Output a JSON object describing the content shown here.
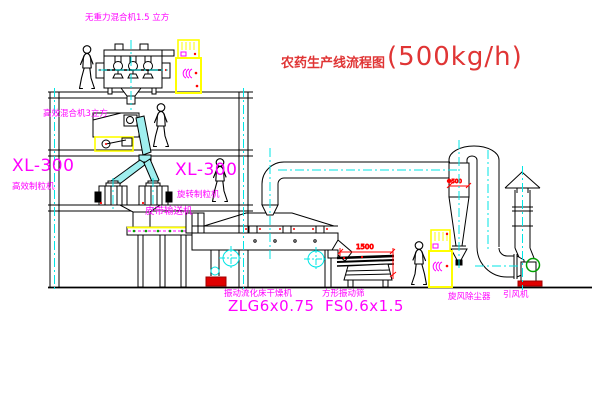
{
  "title": {
    "text": "农药生产线流程图",
    "capacity": "(500kg/h)"
  },
  "labels": {
    "gravity_free_mixer": "无重力混合机1.5 立方",
    "high_efficiency_mixer": "高效混合机3立方",
    "left_granulator_model": "XL-300",
    "left_granulator_name": "高效制粒机",
    "mid_granulator_model": "XL-300",
    "mid_granulator_name": "旋转制粒机",
    "belt_conveyor": "皮带输送机",
    "dryer_name": "振动流化床干燥机",
    "dryer_model": "ZLG6x0.75",
    "screen_name": "方形振动筛",
    "screen_model": "FS0.6x1.5",
    "cyclone": "旋风除尘器",
    "fan": "引风机"
  },
  "dimensions": {
    "screen_length": "1500",
    "cyclone_diameter": "Φ500"
  },
  "colors": {
    "label_magenta": "#FF00FF",
    "title_red": "#E03535",
    "dimension_red": "#FF0000",
    "centerline_cyan": "#00E5E5",
    "cabinet_yellow": "#FFFF00",
    "accent_green": "#00A000",
    "line_black": "#000000",
    "background": "#FFFFFF"
  }
}
